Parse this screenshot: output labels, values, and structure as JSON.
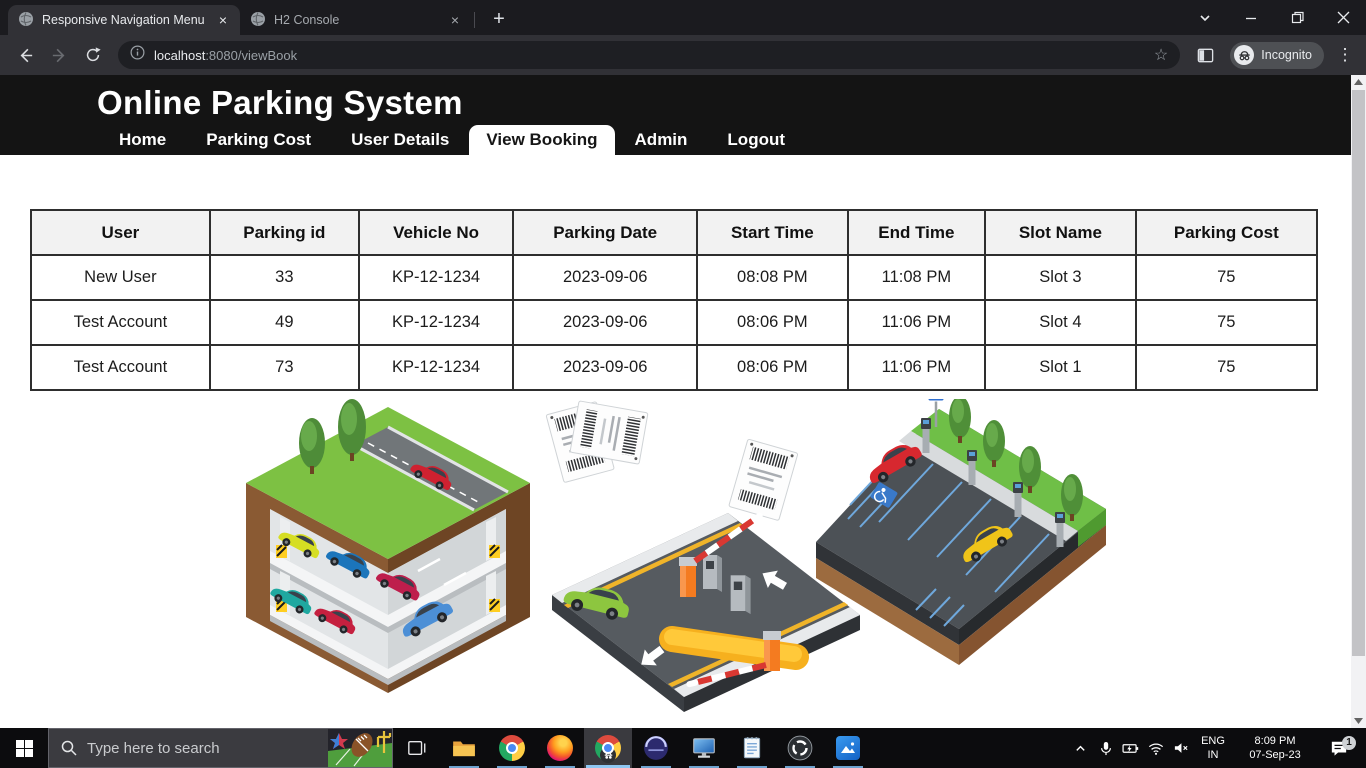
{
  "browser": {
    "tabs": [
      {
        "title": "Responsive Navigation Menu"
      },
      {
        "title": "H2 Console"
      }
    ],
    "glyphs": {
      "tab_close": "×",
      "new_tab": "+",
      "bookmark_star": "☆",
      "menu_kebab": "⋮"
    },
    "address": {
      "host": "localhost",
      "path": ":8080/viewBook"
    },
    "incognito_label": "Incognito"
  },
  "site": {
    "title": "Online Parking System",
    "nav": [
      {
        "label": "Home"
      },
      {
        "label": "Parking Cost"
      },
      {
        "label": "User Details"
      },
      {
        "label": "View Booking"
      },
      {
        "label": "Admin"
      },
      {
        "label": "Logout"
      }
    ],
    "active_nav": "View Booking"
  },
  "booking_table": {
    "headers": [
      "User",
      "Parking id",
      "Vehicle No",
      "Parking Date",
      "Start Time",
      "End Time",
      "Slot Name",
      "Parking Cost"
    ],
    "rows": [
      [
        "New User",
        "33",
        "KP-12-1234",
        "2023-09-06",
        "08:08 PM",
        "11:08 PM",
        "Slot 3",
        "75"
      ],
      [
        "Test Account",
        "49",
        "KP-12-1234",
        "2023-09-06",
        "08:06 PM",
        "11:06 PM",
        "Slot 4",
        "75"
      ],
      [
        "Test Account",
        "73",
        "KP-12-1234",
        "2023-09-06",
        "08:06 PM",
        "11:06 PM",
        "Slot 1",
        "75"
      ]
    ]
  },
  "illustration": {
    "p_sign": "P"
  },
  "taskbar": {
    "search_placeholder": "Type here to search",
    "apps": [
      "file-explorer",
      "chrome",
      "firefox",
      "chrome-incognito",
      "eclipse",
      "remote-desktop",
      "notepad",
      "obs-studio",
      "photos"
    ],
    "tray": {
      "language": "ENG",
      "region": "IN",
      "time": "8:09 PM",
      "date": "07-Sep-23",
      "notification_count": "1"
    }
  },
  "colors": {
    "header_bg": "#141414",
    "toolbar_bg": "#313136",
    "table_header_bg": "#f2f2f2",
    "taskbar_bg": "#0c0c0e",
    "underline_accent": "#8fc7f2"
  }
}
